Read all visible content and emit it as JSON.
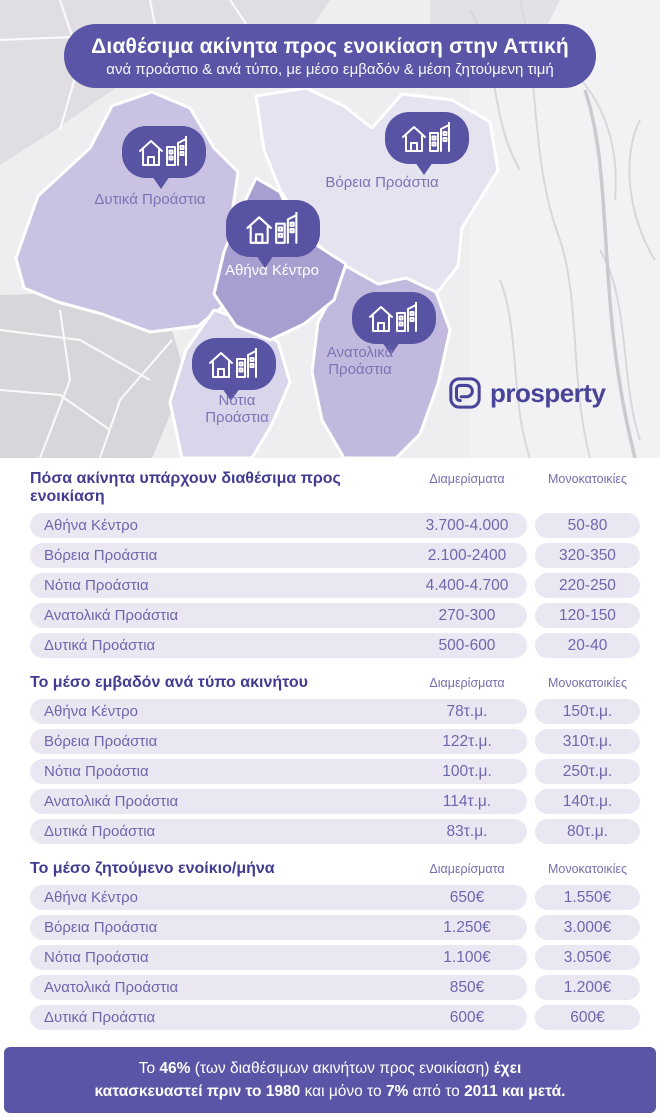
{
  "header": {
    "title": "Διαθέσιμα ακίνητα προς ενοικίαση στην Αττική",
    "subtitle": "ανά προάστιο & ανά τύπο, με μέσο εμβαδόν & μέση ζητούμενη τιμή"
  },
  "map": {
    "regions": [
      {
        "id": "west",
        "label": "Δυτικά Προάστια"
      },
      {
        "id": "north",
        "label": "Βόρεια Προάστια"
      },
      {
        "id": "center",
        "label": "Αθήνα Κέντρο"
      },
      {
        "id": "east",
        "label": "Ανατολικά Προάστια"
      },
      {
        "id": "south",
        "label": "Νότια Προάστια"
      }
    ],
    "marker_icons": [
      "house-icon",
      "buildings-icon"
    ]
  },
  "brand": {
    "name": "prosperty",
    "icon": "prosperty-p-icon",
    "color": "#4a4499"
  },
  "chart_data": [
    {
      "type": "table",
      "title": "Πόσα ακίνητα υπάρχουν διαθέσιμα προς ενοικίαση",
      "columns": [
        "Διαμερίσματα",
        "Μονοκατοικίες"
      ],
      "rows": [
        [
          "Αθήνα Κέντρο",
          "3.700-4.000",
          "50-80"
        ],
        [
          "Βόρεια Προάστια",
          "2.100-2400",
          "320-350"
        ],
        [
          "Νότια Προάστια",
          "4.400-4.700",
          "220-250"
        ],
        [
          "Ανατολικά Προάστια",
          "270-300",
          "120-150"
        ],
        [
          "Δυτικά Προάστια",
          "500-600",
          "20-40"
        ]
      ]
    },
    {
      "type": "table",
      "title": "Το μέσο εμβαδόν ανά τύπο ακινήτου",
      "columns": [
        "Διαμερίσματα",
        "Μονοκατοικίες"
      ],
      "rows": [
        [
          "Αθήνα Κέντρο",
          "78τ.μ.",
          "150τ.μ."
        ],
        [
          "Βόρεια Προάστια",
          "122τ.μ.",
          "310τ.μ."
        ],
        [
          "Νότια Προάστια",
          "100τ.μ.",
          "250τ.μ."
        ],
        [
          "Ανατολικά Προάστια",
          "114τ.μ.",
          "140τ.μ."
        ],
        [
          "Δυτικά Προάστια",
          "83τ.μ.",
          "80τ.μ."
        ]
      ]
    },
    {
      "type": "table",
      "title": "Το μέσο ζητούμενο ενοίκιο/μήνα",
      "columns": [
        "Διαμερίσματα",
        "Μονοκατοικίες"
      ],
      "rows": [
        [
          "Αθήνα Κέντρο",
          "650€",
          "1.550€"
        ],
        [
          "Βόρεια Προάστια",
          "1.250€",
          "3.000€"
        ],
        [
          "Νότια Προάστια",
          "1.100€",
          "3.050€"
        ],
        [
          "Ανατολικά Προάστια",
          "850€",
          "1.200€"
        ],
        [
          "Δυτικά Προάστια",
          "600€",
          "600€"
        ]
      ]
    }
  ],
  "footer": {
    "lines": [
      [
        {
          "t": "Το ",
          "b": false
        },
        {
          "t": "46%",
          "b": true
        },
        {
          "t": " (των διαθέσιμων ακινήτων προς ενοικίαση) ",
          "b": false
        },
        {
          "t": "έχει",
          "b": true
        }
      ],
      [
        {
          "t": "κατασκευαστεί πριν το 1980",
          "b": true
        },
        {
          "t": " και μόνο το ",
          "b": false
        },
        {
          "t": "7%",
          "b": true
        },
        {
          "t": " από το ",
          "b": false
        },
        {
          "t": "2011 και μετά.",
          "b": true
        }
      ]
    ]
  },
  "colors": {
    "accent_purple": "#5a55a6",
    "bubble_purple": "#5953a3",
    "region_center": "#a89fd1",
    "region_west": "#c9c2e3",
    "region_east": "#c2bade",
    "region_south": "#d9d5ea",
    "region_north": "#e6e3f0",
    "table_title": "#423c90",
    "table_text": "#6d67ab",
    "row_pill": "#eae7f3"
  }
}
